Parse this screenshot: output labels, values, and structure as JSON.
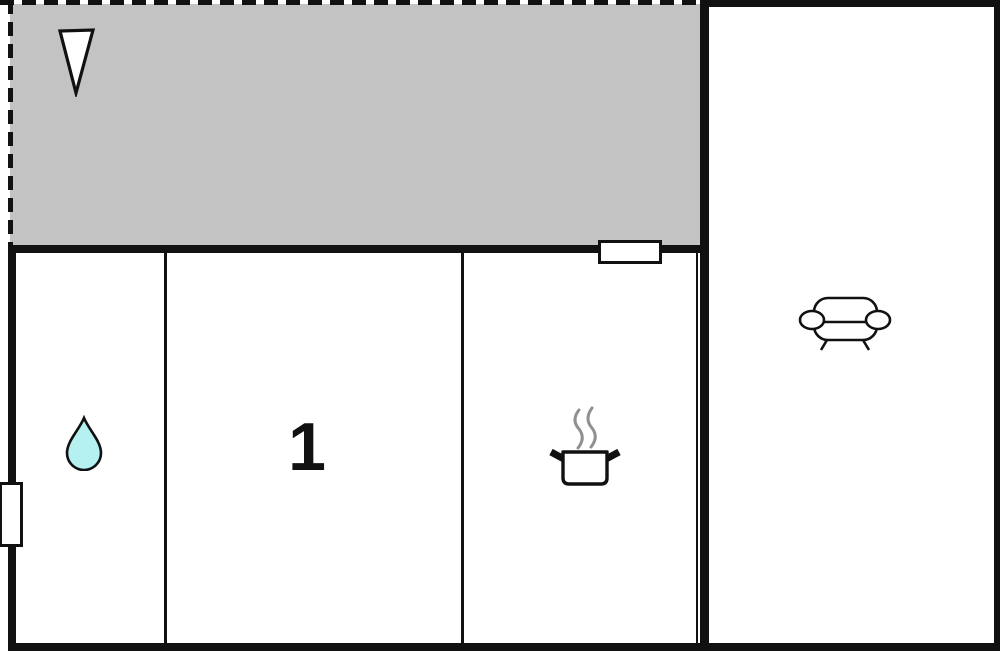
{
  "plan": {
    "type": "floor-plan",
    "colors": {
      "background": "#ffffff",
      "wall": "#111111",
      "terrace_fill": "#c3c3c3",
      "drop_fill": "#b5f1f1",
      "steam": "#909090"
    },
    "terrace": {
      "north_arrow_icon": "north-arrow"
    },
    "rooms": {
      "bathroom": {
        "icon": "water-drop"
      },
      "bedroom": {
        "label": "1"
      },
      "kitchen": {
        "icon": "cooking-pot"
      },
      "living_room": {
        "icon": "sofa"
      }
    },
    "openings": {
      "terrace_window": "window",
      "left_wall_window": "window"
    }
  }
}
